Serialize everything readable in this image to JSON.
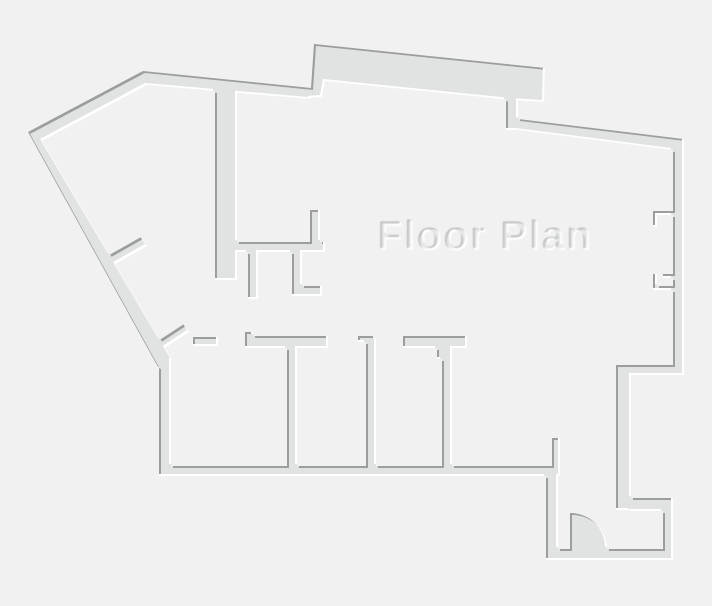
{
  "title": {
    "text": "Floor Plan"
  },
  "colors": {
    "background": "#f1f1f1",
    "wall": "#e1e3e3",
    "rim_dark": "#9b9d9e",
    "rim_light": "#ffffff",
    "text_fill": "#e6e7e7",
    "text_rim_dark": "#c2c4c5",
    "text_rim_light": "#ffffff"
  }
}
